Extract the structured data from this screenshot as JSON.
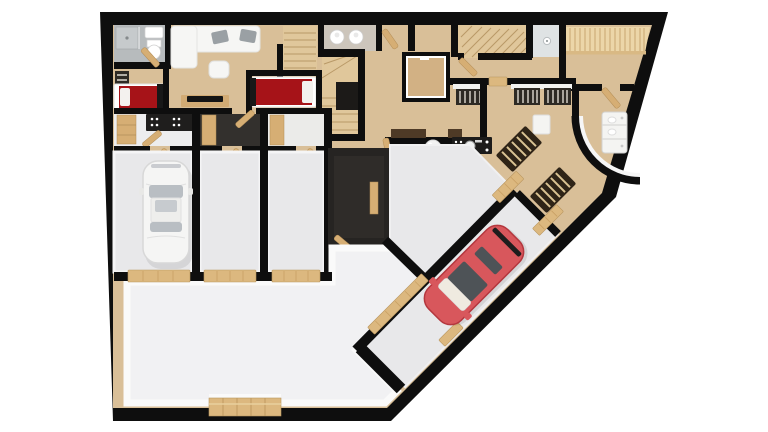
{
  "colors": {
    "page_bg": "#ffffff",
    "wall": "#0e0e0e",
    "wood": "#d9bf98",
    "wood_light": "#e0c79b",
    "slat_wall": "#ecd6a8",
    "slat_line": "#c9a571",
    "garage_floor": "#e8e8ea",
    "basement_floor": "#f1f1f3",
    "wall_top": "#fafafa",
    "dark_floor": "#33302d",
    "black_room": "#262422",
    "black_room_floor": "#2f2c29",
    "tile": "#b7bbbd",
    "shower": "#dfe3e4",
    "door_wood": "#d6ae74",
    "threshold": "#dcb87f",
    "bed_red": "#a61318",
    "pillow": "#f3f1ee",
    "headboard": "#181818",
    "sofa": "#f6f6f4",
    "cushion": "#9aa0a4",
    "tv_black": "#141414",
    "console": "#d2ab74",
    "radiator_dark": "#2e2a24",
    "radiator_fin": "#ded9d0",
    "grate_dark": "#2f2417",
    "grate_step": "#d9c292",
    "car_white": "#f5f5f4",
    "car_white_glass": "#b9bec3",
    "car_red": "#d8575c",
    "car_red_dark": "#b4373e",
    "car_glass_dark": "#4e5357",
    "car_windshield": "#efeae0",
    "island_white": "#f4f4f2",
    "counter_black": "#1c1b1a",
    "void_dark": "#1c1a18",
    "stair_line": "#b2905e",
    "shelf_brown": "#4e3a26",
    "kitchenette_black": "#1f1e1d"
  },
  "floor_plan": {
    "style": "3d-top-down-render",
    "rooms": [
      {
        "name": "bathroom-top-left"
      },
      {
        "name": "bedroom-1"
      },
      {
        "name": "living-room"
      },
      {
        "name": "bedroom-2"
      },
      {
        "name": "wc-room"
      },
      {
        "name": "stair-hall"
      },
      {
        "name": "elevator-shaft"
      },
      {
        "name": "upper-hallway"
      },
      {
        "name": "shower-room-top-right"
      },
      {
        "name": "sauna-room"
      },
      {
        "name": "kitchen-curved-wall"
      },
      {
        "name": "utility-foyer"
      },
      {
        "name": "kitchenette-room"
      },
      {
        "name": "wardrobe-room-dark"
      },
      {
        "name": "wardrobe-room-light"
      },
      {
        "name": "garage-bay-1"
      },
      {
        "name": "garage-bay-2"
      },
      {
        "name": "garage-bay-3"
      },
      {
        "name": "dark-storage-room"
      },
      {
        "name": "diagonal-utility-room"
      },
      {
        "name": "diagonal-garage-bay"
      },
      {
        "name": "basement-hall"
      }
    ],
    "staircases": 3,
    "toilet_count": 2,
    "bed_count": 2,
    "radiator_count": 4,
    "vehicles": [
      {
        "name": "white-car",
        "color_key": "car_white",
        "orientation": "vertical"
      },
      {
        "name": "red-car",
        "color_key": "car_red",
        "orientation": "diagonal-45"
      }
    ],
    "features": [
      {
        "name": "garage-door-bottom"
      },
      {
        "name": "curved-wall-kitchen"
      },
      {
        "name": "diagonal-outer-wall"
      },
      {
        "name": "entry-grate-steps",
        "count": 2
      },
      {
        "name": "door-thresholds-diagonal",
        "count": 4
      }
    ]
  }
}
